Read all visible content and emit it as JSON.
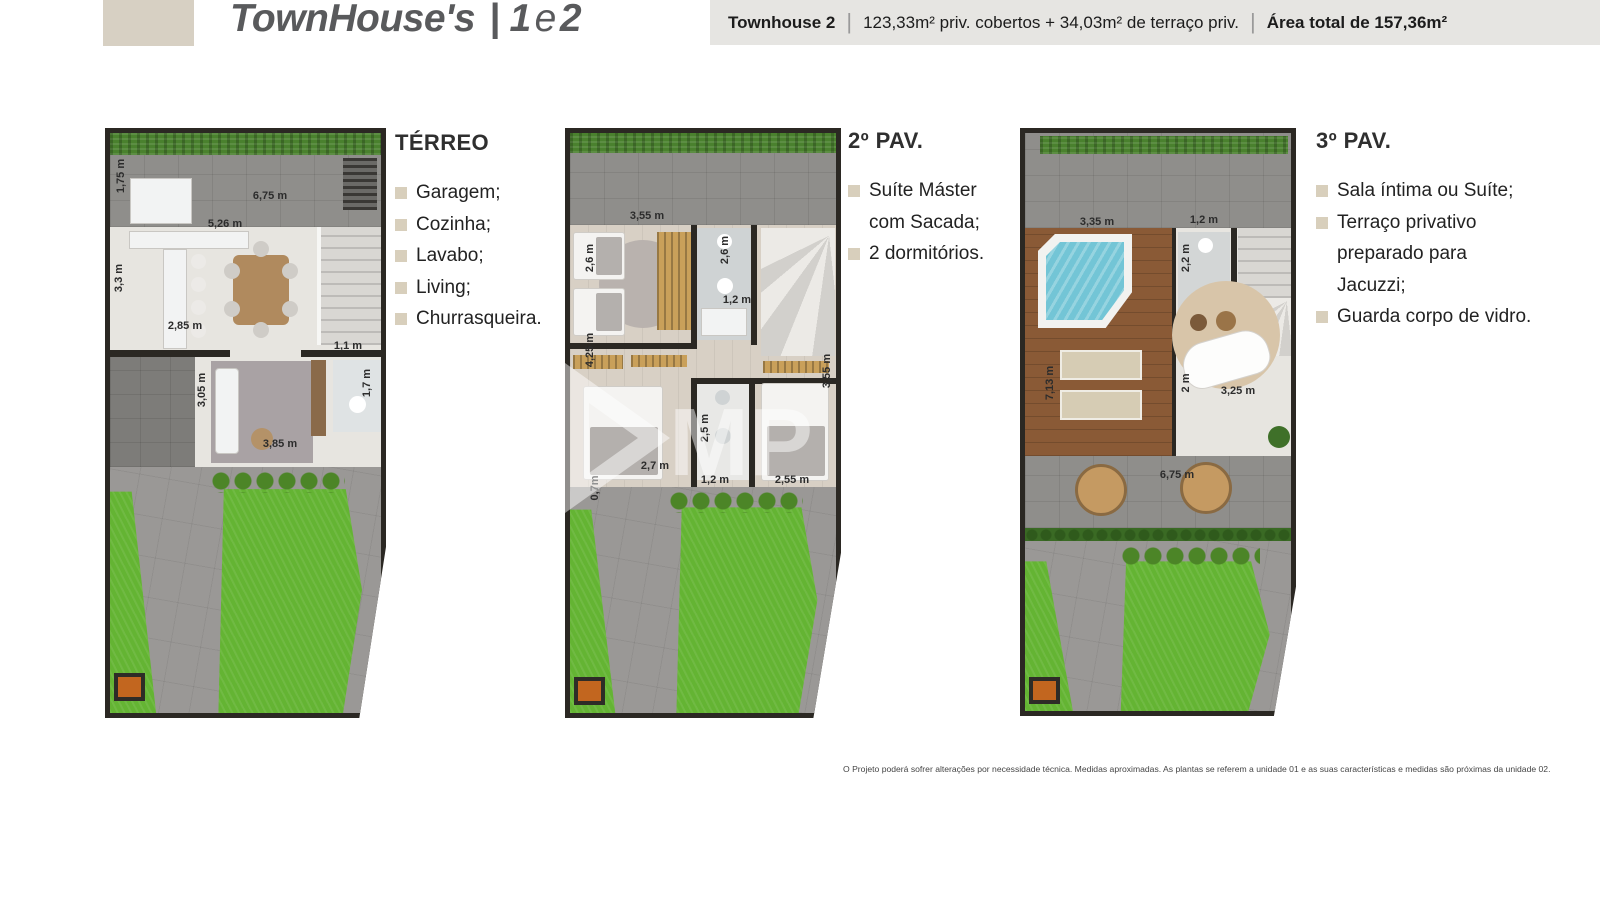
{
  "page": {
    "title": {
      "brand": "TownHouse's",
      "separator": "|",
      "num1": "1",
      "conj": "e",
      "num2": "2"
    },
    "banner": {
      "unit": "Townhouse 2",
      "divider": "|",
      "areas": "123,33m² priv. cobertos + 34,03m² de terraço priv.",
      "total": "Área total de 157,36m²"
    },
    "disclaimer": "O Projeto poderá sofrer alterações por necessidade técnica. Medidas aproximadas. As plantas se referem a unidade 01 e as suas características e medidas são próximas da unidade 02."
  },
  "floors": [
    {
      "heading": "TÉRREO",
      "features": [
        "Garagem;",
        "Cozinha;",
        "Lavabo;",
        "Living;",
        "Churrasqueira."
      ],
      "dims": [
        "1,75 m",
        "6,75 m",
        "5,26 m",
        "3,3 m",
        "2,85 m",
        "3,05 m",
        "1,1 m",
        "1,7 m",
        "3,85 m"
      ]
    },
    {
      "heading": "2º PAV.",
      "features": [
        "Suíte Máster com Sacada;",
        "2 dormitórios."
      ],
      "dims": [
        "3,55 m",
        "2,6 m",
        "2,6 m",
        "1,2 m",
        "4,25 m",
        "2,7 m",
        "2,5 m",
        "1,2 m",
        "3,55 m",
        "2,55 m",
        "0,7m"
      ]
    },
    {
      "heading": "3º PAV.",
      "features": [
        "Sala íntima ou Suíte;",
        "Terraço privativo preparado para Jacuzzi;",
        "Guarda corpo de vidro."
      ],
      "dims": [
        "3,35 m",
        "1,2 m",
        "2,2 m",
        "7,13 m",
        "2 m",
        "3,25 m",
        "6,75 m"
      ]
    }
  ],
  "watermark": {
    "letters": "MP"
  },
  "colors": {
    "accent_beige": "#d7d0c3",
    "title_gray": "#595a5c",
    "banner_bg": "#e6e5e2",
    "wall": "#2b2823",
    "lawn": "#64b433",
    "pool": "#73c5d6",
    "orange_mat": "#c2661f"
  }
}
